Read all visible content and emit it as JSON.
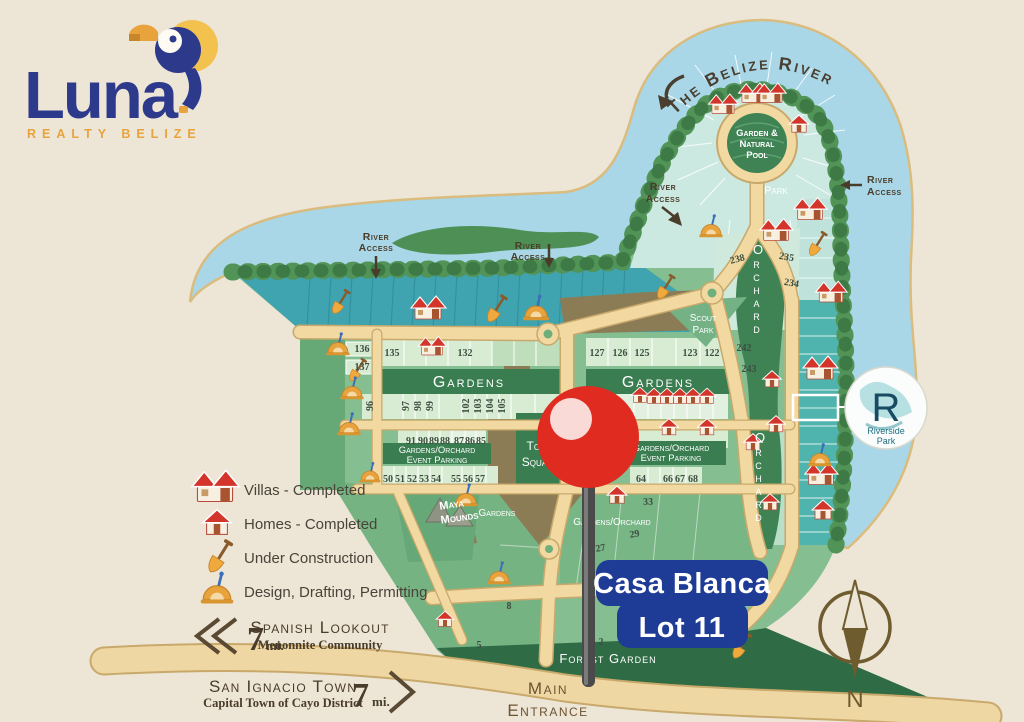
{
  "logo": {
    "name": "Luna",
    "tagline": "REALTY BELIZE"
  },
  "marker": {
    "title": "Casa Blanca",
    "subtitle": "Lot 11"
  },
  "compass": {
    "north": "N"
  },
  "riverside_park": {
    "initial": "R",
    "line1": "Riverside",
    "line2": "Park"
  },
  "legend": {
    "items": [
      {
        "icon": "villa-icon",
        "label": "Villas - Completed"
      },
      {
        "icon": "home-icon",
        "label": "Homes - Completed"
      },
      {
        "icon": "shovel-icon",
        "label": "Under Construction"
      },
      {
        "icon": "protractor-icon",
        "label": "Design, Drafting, Permitting"
      }
    ]
  },
  "directions": {
    "west": {
      "distance": "7",
      "unit": "mi.",
      "name": "Spanish Lookout",
      "subtitle": "Menonnite Community"
    },
    "south": {
      "name": "San Ignacio Town",
      "subtitle": "Capital Town of Cayo District",
      "distance": "7",
      "unit": "mi."
    }
  },
  "map": {
    "river_name": "The Belize River",
    "labels": {
      "garden_pool_1": "Garden &",
      "garden_pool_2": "Natural",
      "garden_pool_3": "Pool",
      "park": "Park",
      "river_access_1": "River",
      "river_access_2": "Access",
      "orchard": "Orchard",
      "scout_1": "Scout",
      "scout_2": "Park",
      "gardens": "Gardens",
      "event_1": "Gardens/Orchard",
      "event_2": "Event Parking",
      "gardens_orchard": "Gardens/Orchard",
      "maya_1": "Maya",
      "maya_2": "Mounds",
      "town_1": "Town",
      "town_2": "Square",
      "forest_garden": "Forest Garden",
      "main_1": "Main",
      "main_2": "Entrance"
    },
    "lots": {
      "136": "136",
      "137": "137",
      "135": "135",
      "132": "132",
      "127": "127",
      "126": "126",
      "125": "125",
      "123": "123",
      "122": "122",
      "238": "238",
      "235": "235",
      "234": "234",
      "242": "242",
      "243": "243",
      "96": "96",
      "97": "97",
      "98": "98",
      "99": "99",
      "102": "102",
      "103": "103",
      "104": "104",
      "105": "105",
      "91": "91",
      "90": "90",
      "89": "89",
      "88": "88",
      "87": "87",
      "86": "86",
      "85": "85",
      "50": "50",
      "51": "51",
      "52": "52",
      "53": "53",
      "54": "54",
      "55": "55",
      "56": "56",
      "57": "57",
      "64": "64",
      "66": "66",
      "67": "67",
      "68": "68",
      "33": "33",
      "27": "27",
      "29": "29",
      "8": "8",
      "5": "5",
      "2": "2"
    }
  },
  "colors": {
    "background": "#EDE5D6",
    "water": "#A9D7E8",
    "tree": "#4C8B52",
    "road": "#F2D9A2",
    "teal_lots": "#3FA4B0",
    "banner_green": "#3A7D50",
    "pin_red": "#E02B20",
    "badge_blue": "#1E3C96",
    "logo_blue": "#2D3A8C",
    "logo_orange": "#E8A33D"
  }
}
